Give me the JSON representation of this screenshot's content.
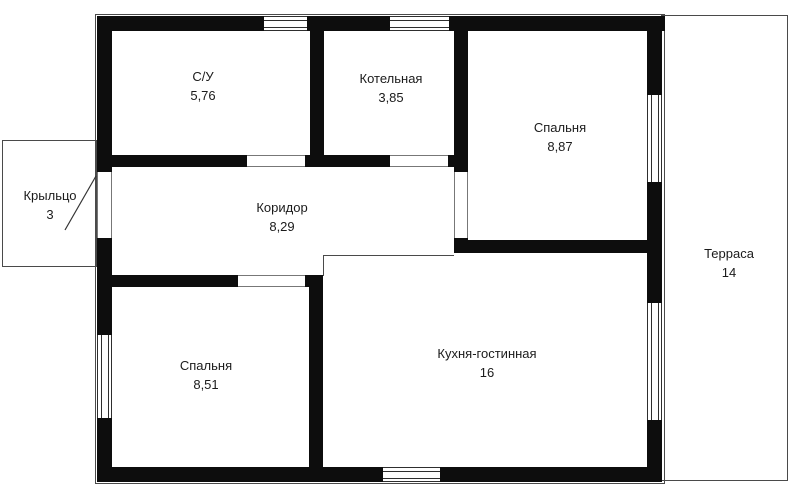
{
  "plan": {
    "rooms": [
      {
        "name": "С/У",
        "area": "5,76"
      },
      {
        "name": "Котельная",
        "area": "3,85"
      },
      {
        "name": "Спальня",
        "area": "8,87"
      },
      {
        "name": "Коридор",
        "area": "8,29"
      },
      {
        "name": "Крыльцо",
        "area": "3"
      },
      {
        "name": "Спальня",
        "area": "8,51"
      },
      {
        "name": "Кухня-гостинная",
        "area": "16"
      },
      {
        "name": "Терраса",
        "area": "14"
      }
    ],
    "colors": {
      "wall": "#0d0d0d",
      "outline": "#4a4a4a",
      "text": "#1b1b1b",
      "background": "#ffffff"
    }
  }
}
